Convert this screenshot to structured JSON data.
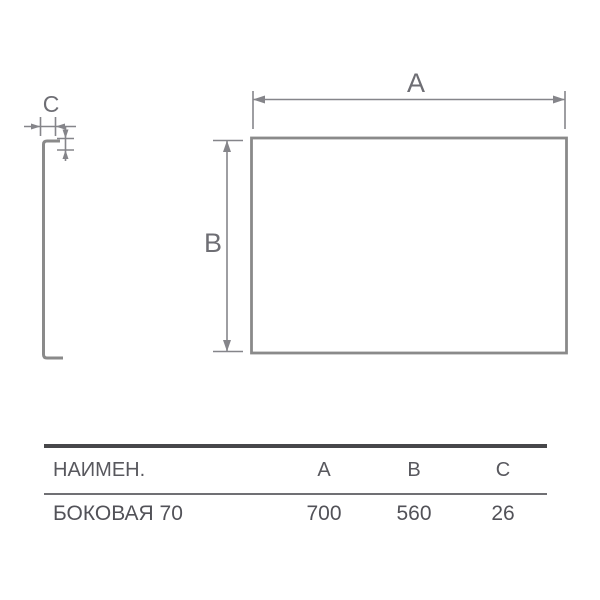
{
  "drawing": {
    "labels": {
      "a": "A",
      "b": "B",
      "c": "C"
    }
  },
  "table": {
    "headers": {
      "name": "НАИМЕН.",
      "a": "A",
      "b": "B",
      "c": "C"
    },
    "row": {
      "name": "БОКОВАЯ 70",
      "a": "700",
      "b": "560",
      "c": "26"
    }
  },
  "colors": {
    "drawing_line": "#8a8a8a",
    "dimension_line": "#85858a",
    "dim_label_text": "#6e6e74",
    "table_text": "#55555b",
    "table_top_rule": "#47474a",
    "table_mid_rule": "#707074",
    "background": "#ffffff"
  }
}
